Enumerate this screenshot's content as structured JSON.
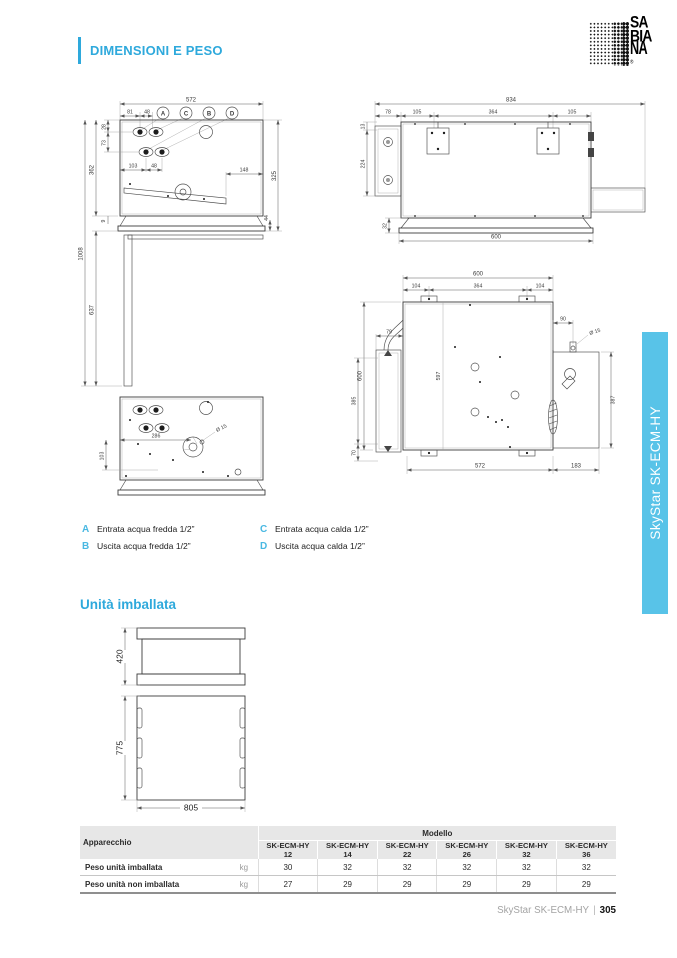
{
  "colors": {
    "accent": "#2ea9dc",
    "tab": "#58c3e8"
  },
  "header": {
    "title": "DIMENSIONI E PESO"
  },
  "logo": {
    "l1": "SA",
    "l2": "BIA",
    "l3": "NA",
    "reg": "®"
  },
  "side_tab": {
    "label": "SkyStar SK-ECM-HY"
  },
  "drawings": {
    "front": {
      "w": "572",
      "s1": "81",
      "s2": "48",
      "la": "A",
      "lc": "C",
      "lb": "B",
      "ld": "D",
      "l1": "28",
      "l2": "73",
      "l3": "362",
      "i1": "103",
      "i2": "48",
      "r1": "148",
      "r2": "325",
      "r3": "44",
      "b1": "9",
      "v1": "1008",
      "v2": "637"
    },
    "under": {
      "w": "286",
      "dia": "Ø 15",
      "h": "103"
    },
    "side": {
      "w": "834",
      "s1": "78",
      "s2": "105",
      "s3": "364",
      "s4": "105",
      "l1": "13",
      "l2": "224",
      "b1": "32",
      "b2": "600"
    },
    "plan": {
      "w": "600",
      "s1": "104",
      "s2": "364",
      "s3": "104",
      "c1": "79",
      "lv": "600",
      "l1": "385",
      "l2": "70",
      "mid": "597",
      "r1": "90",
      "dia": "Ø 15",
      "r2": "387",
      "b1": "572",
      "b2": "183"
    },
    "packed": {
      "h1": "420",
      "h2": "775",
      "w": "805"
    }
  },
  "legend": {
    "items": [
      {
        "k": "A",
        "t": "Entrata acqua fredda 1/2”"
      },
      {
        "k": "B",
        "t": "Uscita acqua fredda 1/2”"
      },
      {
        "k": "C",
        "t": "Entrata acqua calda 1/2”"
      },
      {
        "k": "D",
        "t": "Uscita acqua calda 1/2”"
      }
    ]
  },
  "packed_section": {
    "title": "Unità imballata"
  },
  "table": {
    "corner": "Apparecchio",
    "group": "Modello",
    "models": [
      "SK-ECM-HY 12",
      "SK-ECM-HY 14",
      "SK-ECM-HY 22",
      "SK-ECM-HY 26",
      "SK-ECM-HY 32",
      "SK-ECM-HY 36"
    ],
    "rows": [
      {
        "label": "Peso unità imballata",
        "unit": "kg",
        "values": [
          "30",
          "32",
          "32",
          "32",
          "32",
          "32"
        ]
      },
      {
        "label": "Peso unità non imballata",
        "unit": "kg",
        "values": [
          "27",
          "29",
          "29",
          "29",
          "29",
          "29"
        ]
      }
    ]
  },
  "footer": {
    "product": "SkyStar SK-ECM-HY",
    "divider": "|",
    "page": "305"
  }
}
